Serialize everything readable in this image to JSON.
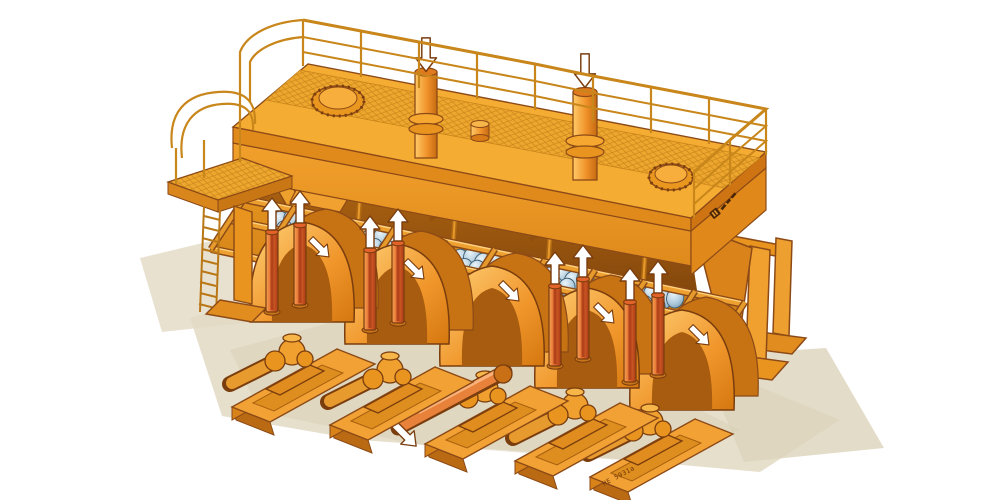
{
  "figure": {
    "kind": "isometric cutaway technical illustration of an industrial machine",
    "machine": {
      "drive_units": 5,
      "top_inlet_cylinders": 2,
      "inspection_manholes": 2,
      "ball_cluster_groups": 9,
      "support_legs_visible": 4,
      "has_access_ladder": true,
      "has_perimeter_railing": true
    }
  },
  "labels": {
    "part_number": "HE 5931a"
  },
  "brand": {
    "logo": "small dark italic wordmark on right end face (illegible at this scale)"
  },
  "icons": {
    "inlet_arrow_icon": {
      "shape": "white outline arrow pointing down into top cylinders",
      "count": 2,
      "fill": "#FFFFFF"
    },
    "up_arrow_icon": {
      "shape": "white outline arrows pointing up from red drive cylinders",
      "count": 8,
      "fill": "#FFFFFF"
    },
    "drum_arrow_icon": {
      "shape": "white arrows on drum covers pointing down-left",
      "count": 5,
      "fill": "#FFFFFF"
    },
    "shaft_arrow_icon": {
      "shape": "white outline arrow at end of front drive shaft",
      "count": 1,
      "fill": "#FFFFFF"
    }
  },
  "palette": {
    "body_orange": "#F5A42D",
    "body_highlight": "#FFCB63",
    "body_shadow": "#D8821A",
    "outline_brown": "#7A3D0E",
    "cavity_dark": "#9A5510",
    "red_cylinder": "#D8572B",
    "ball_blue": "#A9C6D8",
    "ball_blue_deep": "#5E869F",
    "grating_line": "#C9851B",
    "ground_shadow": "#E2D9C3",
    "background": "#FFFFFF"
  }
}
